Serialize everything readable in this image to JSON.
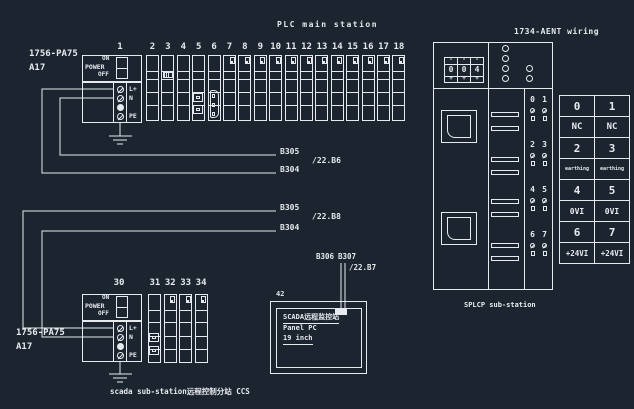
{
  "colors": {
    "background": "#1c2430",
    "ink": "#e6eaee"
  },
  "main_station": {
    "title": "PLC main station",
    "slot_numbers": [
      "1",
      "2",
      "3",
      "4",
      "5",
      "6",
      "7",
      "8",
      "9",
      "10",
      "11",
      "12",
      "13",
      "14",
      "15",
      "16",
      "17",
      "18"
    ]
  },
  "labels": {
    "main_psu1": "1756-PA75",
    "main_psu2": "A17",
    "sub_psu1": "1756-PA75",
    "sub_psu2": "A17"
  },
  "power_module": {
    "label": "POWER",
    "on": "ON",
    "off": "OFF",
    "terminals": [
      "L+",
      "N",
      "PE"
    ]
  },
  "wire_labels": {
    "upper": {
      "top": "B305",
      "ref": "/22.B6",
      "bottom": "B304"
    },
    "lower": {
      "top": "B305",
      "ref": "/22.B8",
      "bottom": "B304"
    }
  },
  "panel_pc": {
    "tag": "42",
    "b306": "B306",
    "b307": "B307",
    "ref": "/22.B7",
    "lines": [
      "SCADA远程监控站",
      "Panel PC",
      "19 inch"
    ]
  },
  "sub_station": {
    "slot_numbers": [
      "30",
      "31",
      "32",
      "33",
      "34"
    ],
    "caption": "scada sub-station远程控制分站 CCS"
  },
  "aent": {
    "title": "1734-AENT wiring",
    "minus": "-",
    "plus": "+",
    "digits": [
      "0",
      "0",
      "4"
    ],
    "terminal_pairs": [
      [
        "0",
        "1"
      ],
      [
        "2",
        "3"
      ],
      [
        "4",
        "5"
      ],
      [
        "6",
        "7"
      ]
    ],
    "caption": "SPLCP sub-station"
  },
  "wiring_table": {
    "rows": [
      [
        "0",
        "1"
      ],
      [
        "NC",
        "NC"
      ],
      [
        "2",
        "3"
      ],
      [
        "earthing",
        "earthing"
      ],
      [
        "4",
        "5"
      ],
      [
        "0VI",
        "0VI"
      ],
      [
        "6",
        "7"
      ],
      [
        "+24VI",
        "+24VI"
      ]
    ]
  }
}
